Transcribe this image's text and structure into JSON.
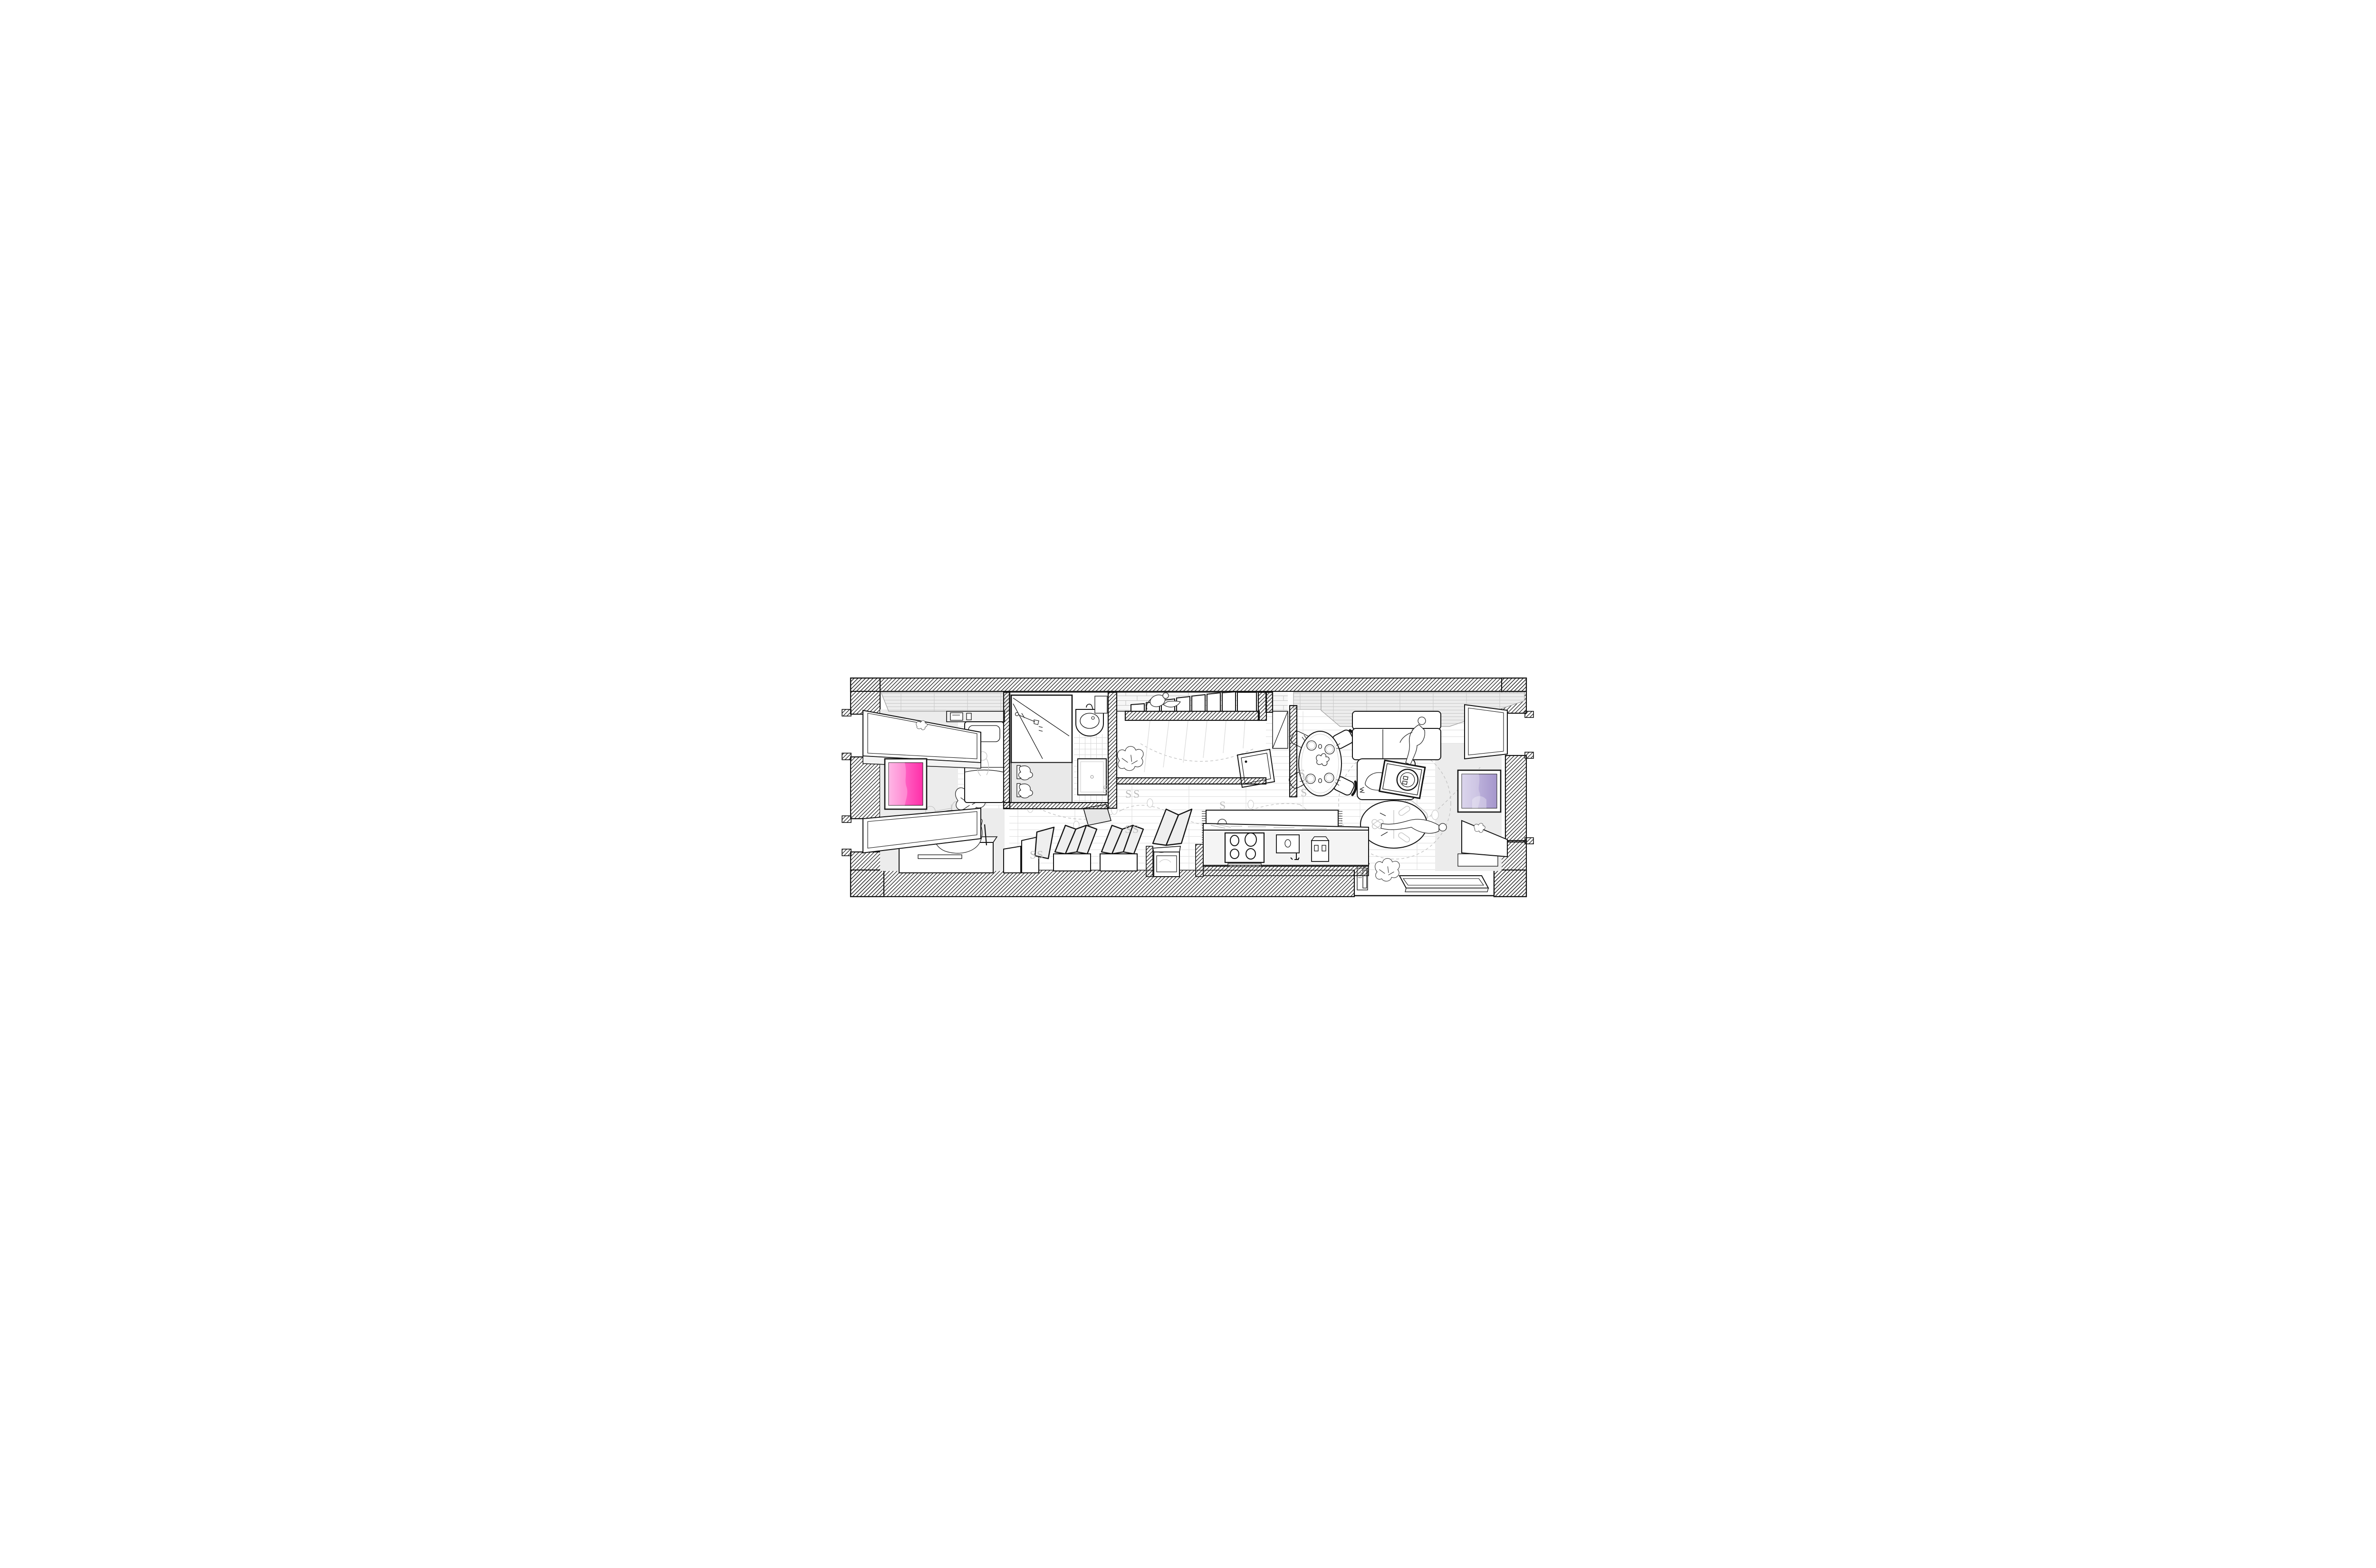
{
  "scene": {
    "kind": "architectural-axonometric-floor-plan",
    "view": "top-down cutaway of a long narrow apartment",
    "rooms": [
      "lounge",
      "bedroom",
      "bathroom",
      "staircase",
      "corridor",
      "kitchen",
      "dining",
      "living",
      "study-nook"
    ],
    "people": [
      {
        "id": "person-reading",
        "activity": "sitting in butterfly chair with book",
        "room": "lounge"
      },
      {
        "id": "child-standing",
        "activity": "toddler standing by bench",
        "room": "lounge"
      },
      {
        "id": "person-climbing",
        "activity": "climbing the stairs",
        "room": "staircase"
      },
      {
        "id": "person-walking",
        "activity": "standing on runner rug",
        "room": "corridor"
      },
      {
        "id": "person-cleaning",
        "activity": "standing over the sofa",
        "room": "living"
      },
      {
        "id": "person-stretching",
        "activity": "lying across round table",
        "room": "living"
      }
    ],
    "animals": [
      {
        "id": "dog",
        "activity": "curled asleep on sofa chaise",
        "room": "living"
      }
    ],
    "plants": {
      "type": "monstera",
      "count": 6
    }
  },
  "colors": {
    "paper": "#ffffff",
    "line": "#141414",
    "ghost": "#c4c4c4",
    "room_fill": "#ececec",
    "pink_light": "#ff9bdc",
    "pink_deep": "#ff2fa8",
    "purple_light": "#cfc7e6",
    "purple_deep": "#a596cc"
  },
  "artworks": {
    "left": {
      "name": "pink abstract artwork",
      "wall": "left end pier"
    },
    "right": {
      "name": "purple abstract artwork",
      "wall": "right end pier"
    }
  },
  "fixtures": [
    "bed",
    "wardrobe-shelf",
    "wall-control-panel",
    "vanity-cabinet",
    "grooming-tools",
    "towels",
    "wash-basin",
    "mirror-cabinet",
    "shower-tray",
    "stair-treads",
    "open-door",
    "dining-table",
    "place-settings",
    "dining-chairs",
    "sofa",
    "washing-machine",
    "ceiling-fan",
    "round-rug",
    "runner-rug",
    "kitchen-island",
    "cooktop",
    "kitchen-sink",
    "espresso-machine",
    "freestanding-cooker",
    "bifold-panels",
    "step-benches",
    "drawer-cabinet",
    "telephone",
    "low-platform",
    "window-bays"
  ],
  "floor_glyphs": {
    "char": "S",
    "positions": [
      [
        600,
        524
      ],
      [
        648,
        534
      ],
      [
        665,
        534
      ],
      [
        647,
        608
      ],
      [
        663,
        608
      ],
      [
        846,
        558
      ],
      [
        1013,
        491
      ],
      [
        1021,
        505
      ],
      [
        1017,
        531
      ],
      [
        447,
        662
      ],
      [
        462,
        662
      ]
    ]
  }
}
